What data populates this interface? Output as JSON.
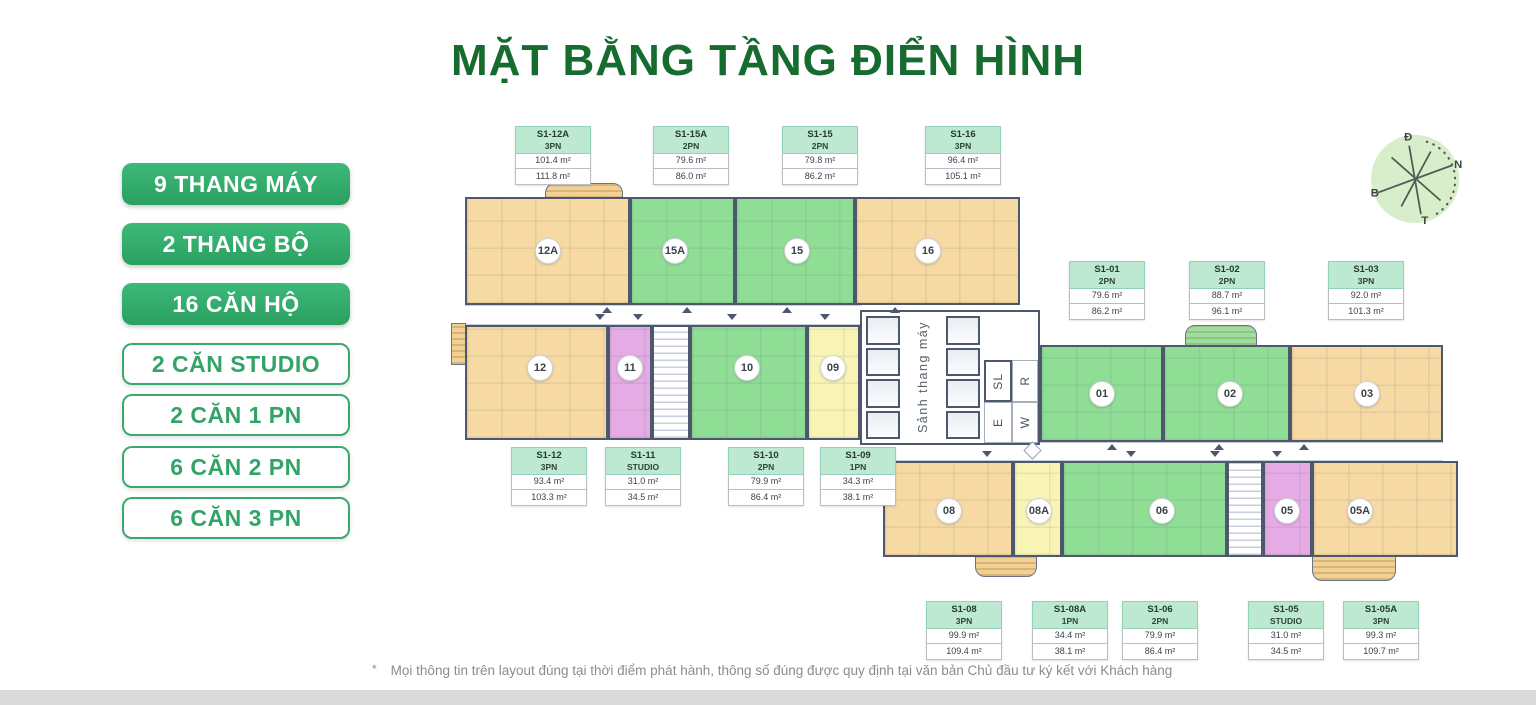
{
  "title": "MẶT BẰNG TẦNG ĐIỂN HÌNH",
  "legend": {
    "items": [
      {
        "label": "9 THANG MÁY",
        "style": "filled"
      },
      {
        "label": "2 THANG BỘ",
        "style": "filled"
      },
      {
        "label": "16 CĂN HỘ",
        "style": "filled"
      },
      {
        "label": "2 CĂN STUDIO",
        "style": "outlined"
      },
      {
        "label": "2 CĂN 1 PN",
        "style": "outlined"
      },
      {
        "label": "6 CĂN 2 PN",
        "style": "outlined"
      },
      {
        "label": "6 CĂN 3 PN",
        "style": "outlined"
      }
    ]
  },
  "compass": {
    "d": "Đ",
    "n": "N",
    "b": "B",
    "t": "T"
  },
  "colors": {
    "brand_green": "#2fa566",
    "title_green": "#166b2e",
    "unit_3pn_orange": "#f6d9a3",
    "unit_2pn_green": "#90dd96",
    "unit_1pn_yellow": "#f9f3b5",
    "unit_studio_pink": "#e5abe5",
    "wall": "#4e586c",
    "label_header_green": "#bde9d2"
  },
  "floor_plan": {
    "core": {
      "lobby": "Sảnh thang máy",
      "sl": "SL",
      "e": "E",
      "r": "R",
      "w": "W"
    },
    "units": [
      {
        "number": "12A",
        "type": "3PN"
      },
      {
        "number": "15A",
        "type": "2PN"
      },
      {
        "number": "15",
        "type": "2PN"
      },
      {
        "number": "16",
        "type": "3PN"
      },
      {
        "number": "12",
        "type": "3PN"
      },
      {
        "number": "11",
        "type": "STUDIO"
      },
      {
        "number": "10",
        "type": "2PN"
      },
      {
        "number": "09",
        "type": "1PN"
      },
      {
        "number": "01",
        "type": "2PN"
      },
      {
        "number": "02",
        "type": "2PN"
      },
      {
        "number": "03",
        "type": "3PN"
      },
      {
        "number": "08",
        "type": "3PN"
      },
      {
        "number": "08A",
        "type": "1PN"
      },
      {
        "number": "06",
        "type": "2PN"
      },
      {
        "number": "05",
        "type": "STUDIO"
      },
      {
        "number": "05A",
        "type": "3PN"
      }
    ]
  },
  "unit_labels": [
    {
      "code": "S1-12A",
      "type": "3PN",
      "area1": "101.4 m²",
      "area2": "111.8 m²"
    },
    {
      "code": "S1-15A",
      "type": "2PN",
      "area1": "79.6 m²",
      "area2": "86.0 m²"
    },
    {
      "code": "S1-15",
      "type": "2PN",
      "area1": "79.8 m²",
      "area2": "86.2 m²"
    },
    {
      "code": "S1-16",
      "type": "3PN",
      "area1": "96.4 m²",
      "area2": "105.1 m²"
    },
    {
      "code": "S1-01",
      "type": "2PN",
      "area1": "79.6 m²",
      "area2": "86.2 m²"
    },
    {
      "code": "S1-02",
      "type": "2PN",
      "area1": "88.7 m²",
      "area2": "96.1 m²"
    },
    {
      "code": "S1-03",
      "type": "3PN",
      "area1": "92.0 m²",
      "area2": "101.3 m²"
    },
    {
      "code": "S1-12",
      "type": "3PN",
      "area1": "93.4 m²",
      "area2": "103.3 m²"
    },
    {
      "code": "S1-11",
      "type": "STUDIO",
      "area1": "31.0 m²",
      "area2": "34.5 m²"
    },
    {
      "code": "S1-10",
      "type": "2PN",
      "area1": "79.9 m²",
      "area2": "86.4 m²"
    },
    {
      "code": "S1-09",
      "type": "1PN",
      "area1": "34.3 m²",
      "area2": "38.1 m²"
    },
    {
      "code": "S1-08",
      "type": "3PN",
      "area1": "99.9 m²",
      "area2": "109.4 m²"
    },
    {
      "code": "S1-08A",
      "type": "1PN",
      "area1": "34.4 m²",
      "area2": "38.1 m²"
    },
    {
      "code": "S1-06",
      "type": "2PN",
      "area1": "79.9 m²",
      "area2": "86.4 m²"
    },
    {
      "code": "S1-05",
      "type": "STUDIO",
      "area1": "31.0 m²",
      "area2": "34.5 m²"
    },
    {
      "code": "S1-05A",
      "type": "3PN",
      "area1": "99.3 m²",
      "area2": "109.7 m²"
    }
  ],
  "footnote": {
    "marker": "*",
    "text": "Mọi thông tin trên layout đúng tại thời điểm phát hành, thông số đúng được quy định tại văn bản Chủ đầu tư ký kết với Khách hàng"
  }
}
